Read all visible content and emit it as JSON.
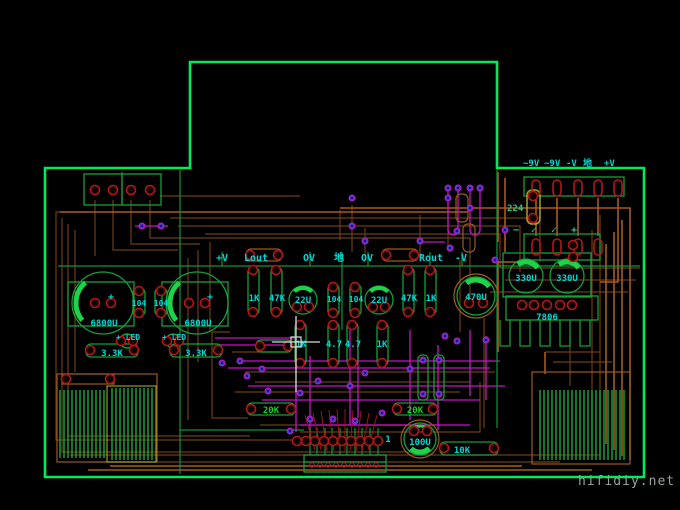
{
  "watermark": "hifidiy.net",
  "colors": {
    "board_outline": "#00e95f",
    "trace_copper": "#a85a1e",
    "trace_signal": "#6e3d14",
    "trace_jumper": "#c714c7",
    "trace_green": "#0e9636",
    "silk_green": "#14a038",
    "label_cyan": "#00d6d6",
    "label_green": "#19d219",
    "pad_red": "#b41616",
    "via_blue": "#3c3ccc"
  },
  "power_header": {
    "ac1": "~9V",
    "ac2": "~9V",
    "neg": "-V",
    "gnd": "地",
    "pos": "+V"
  },
  "signal_header": {
    "pos": "+V",
    "lout": "Lout",
    "zero1": "OV",
    "gnd": "地",
    "zero2": "OV",
    "rout": "Rout",
    "neg": "-V"
  },
  "marks": {
    "minus": "−",
    "check1": "✓",
    "check2": "✓",
    "plus": "+",
    "cap_left_plus": "+",
    "cap_right_plus": "+"
  },
  "components": {
    "bulk_cap_left": "6800U",
    "bulk_cap_right": "6800U",
    "film_cap_1": "104",
    "film_cap_2": "104",
    "film_cap_3": "104",
    "film_cap_4": "104",
    "led_left": "+ LED",
    "led_right": "+ LED",
    "res_33k_left": "3.3K",
    "res_33k_right": "3.3K",
    "res_1k_in_l": "1K",
    "res_47k_l": "47K",
    "cap_22u_l": "22U",
    "cap_22u_r": "22U",
    "res_47k_r": "47K",
    "res_1k_in_r": "1K",
    "cap_470u": "470U",
    "cap_330u_1": "330U",
    "cap_330u_2": "330U",
    "regulator": "7806",
    "cap_224": "224",
    "res_1k_fb_l": "1K",
    "res_47_l": "4.7",
    "res_47_r": "4.7",
    "res_1k_fb_r": "1K",
    "res_20k_l": "20K",
    "res_20k_r": "20K",
    "cap_100u": "100U",
    "res_10k": "10K",
    "pot_pin1": "1"
  }
}
